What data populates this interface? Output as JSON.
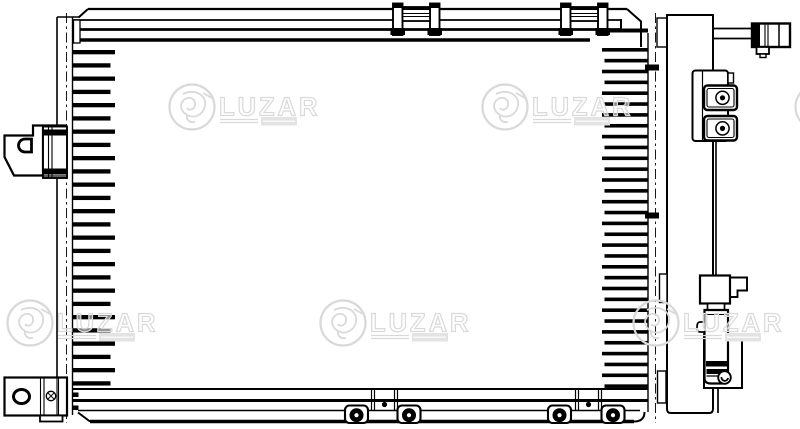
{
  "title": "Technical line drawing of automotive A/C condenser with receiver drier",
  "colors": {
    "background": "#ffffff",
    "line": "#000000",
    "watermark_stroke": "#d9d9d9",
    "watermark_fill": "rgba(255,255,255,0.55)",
    "watermark_block": "#e3e3e3"
  },
  "watermark": {
    "text": "LUZAR",
    "logo_radius": 22.5,
    "tiles": [
      {
        "cx": 192,
        "cy": 107
      },
      {
        "cx": 505,
        "cy": 107
      },
      {
        "cx": 818,
        "cy": 107
      },
      {
        "cx": 30,
        "cy": 323
      },
      {
        "cx": 343,
        "cy": 323
      },
      {
        "cx": 656,
        "cy": 323
      }
    ]
  },
  "tubes": {
    "left": {
      "x1": 72.5,
      "x2": 115,
      "x2_alt": 110.5,
      "y_start": 50,
      "pitch": 13.25,
      "count": 26,
      "thickness": 4.3
    },
    "right": {
      "x1": 602,
      "x1_alt": 604.5,
      "x2": 648,
      "y_start": 48,
      "pitch": 10.85,
      "count": 32,
      "thickness": 3.6,
      "extra_top_y": 28.5
    },
    "stubs": [
      {
        "x": 72.5,
        "y": 392.5,
        "w": 6,
        "h": 4.5
      },
      {
        "x": 72.5,
        "y": 405.5,
        "w": 6,
        "h": 4.5
      }
    ]
  },
  "top_brackets": {
    "x_positions": [
      391,
      559
    ]
  },
  "feet_assemblies": [
    {
      "center_x": 383,
      "screw_xs": [
        356.5,
        409
      ]
    },
    {
      "center_x": 587,
      "screw_xs": [
        559.5,
        613
      ]
    }
  ]
}
